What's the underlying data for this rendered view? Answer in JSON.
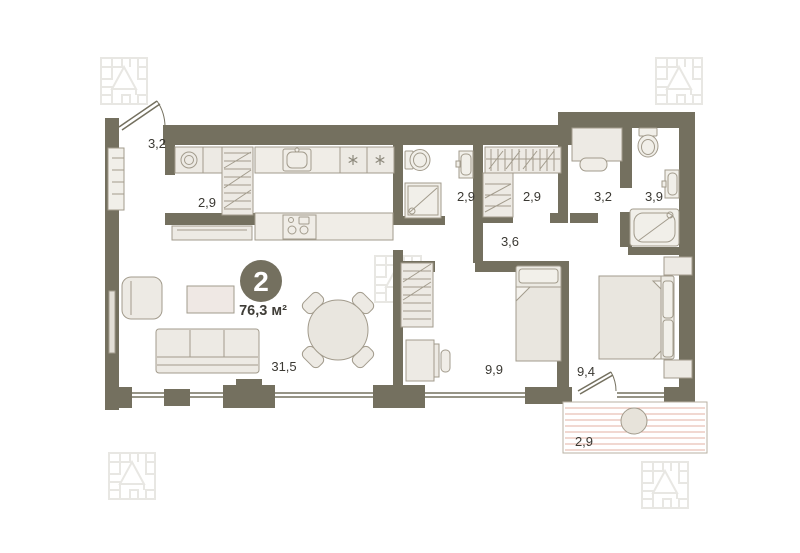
{
  "plan": {
    "badge": {
      "rooms_count": "2",
      "total_area": "76,3 м²"
    },
    "rooms": [
      {
        "name": "hallway",
        "area": "3,2"
      },
      {
        "name": "storage",
        "area": "2,9"
      },
      {
        "name": "bathroom",
        "area": "2,9"
      },
      {
        "name": "wardrobe-room",
        "area": "2,9"
      },
      {
        "name": "study",
        "area": "3,2"
      },
      {
        "name": "bathroom-2",
        "area": "3,9"
      },
      {
        "name": "corridor",
        "area": "3,6"
      },
      {
        "name": "living-kitchen",
        "area": "31,5"
      },
      {
        "name": "bedroom",
        "area": "9,9"
      },
      {
        "name": "bedroom-2",
        "area": "9,4"
      },
      {
        "name": "balcony",
        "area": "2,9"
      }
    ],
    "icons": {
      "fridge": "snowflake-icon",
      "corner_watermark": "developer-maze-logo"
    },
    "colors": {
      "wall": "#74705f",
      "furniture_fill": "#edeae4",
      "furniture_stroke": "#a29b8c",
      "counter_fill": "#f0ede7",
      "badge_bg": "#74705f",
      "badge_text": "#ffffff",
      "label_text": "#3b3933",
      "balcony_stripe": "#e3b2a3",
      "logo": "#e8e7e3"
    }
  }
}
